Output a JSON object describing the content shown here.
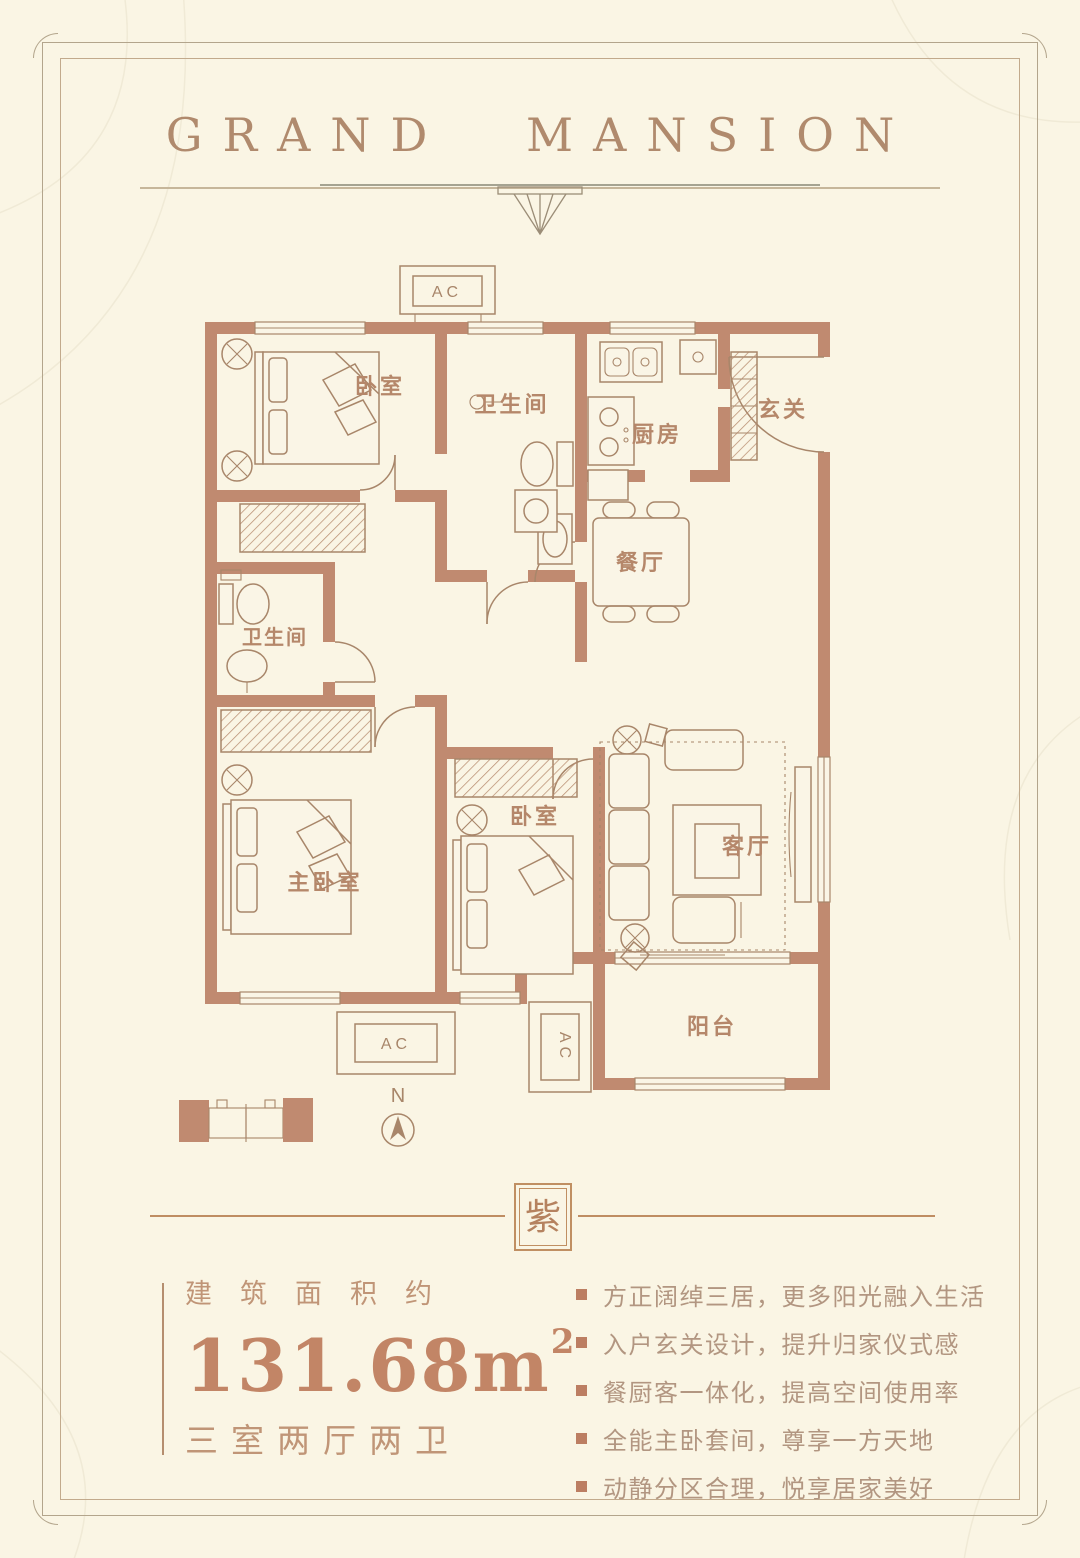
{
  "header": {
    "title": "GRAND MANSION"
  },
  "floorplan": {
    "ac_label": "AC",
    "north_label": "N",
    "rooms": [
      {
        "id": "bedroom-1",
        "label": "卧室"
      },
      {
        "id": "bathroom-1",
        "label": "卫生间"
      },
      {
        "id": "kitchen",
        "label": "厨房"
      },
      {
        "id": "foyer",
        "label": "玄关"
      },
      {
        "id": "dining",
        "label": "餐厅"
      },
      {
        "id": "bathroom-2",
        "label": "卫生间"
      },
      {
        "id": "master-bedroom",
        "label": "主卧室"
      },
      {
        "id": "bedroom-2",
        "label": "卧室"
      },
      {
        "id": "living-room",
        "label": "客厅"
      },
      {
        "id": "balcony",
        "label": "阳台"
      }
    ]
  },
  "seal": {
    "character": "紫"
  },
  "info": {
    "area_caption": "建筑面积约",
    "area_value": "131.68m",
    "area_sup": "2",
    "layout": "三室两厅两卫"
  },
  "features": [
    "方正阔绰三居，更多阳光融入生活",
    "入户玄关设计，提升归家仪式感",
    "餐厨客一体化，提高空间使用率",
    "全能主卧套间，尊享一方天地",
    "动静分区合理，悦享居家美好"
  ],
  "colors": {
    "background": "#faf5e4",
    "wall": "#c08a70",
    "line": "#a8866a",
    "accent_text": "#c09577",
    "bullet": "#bc7e62",
    "frame": "#b3a58c"
  }
}
